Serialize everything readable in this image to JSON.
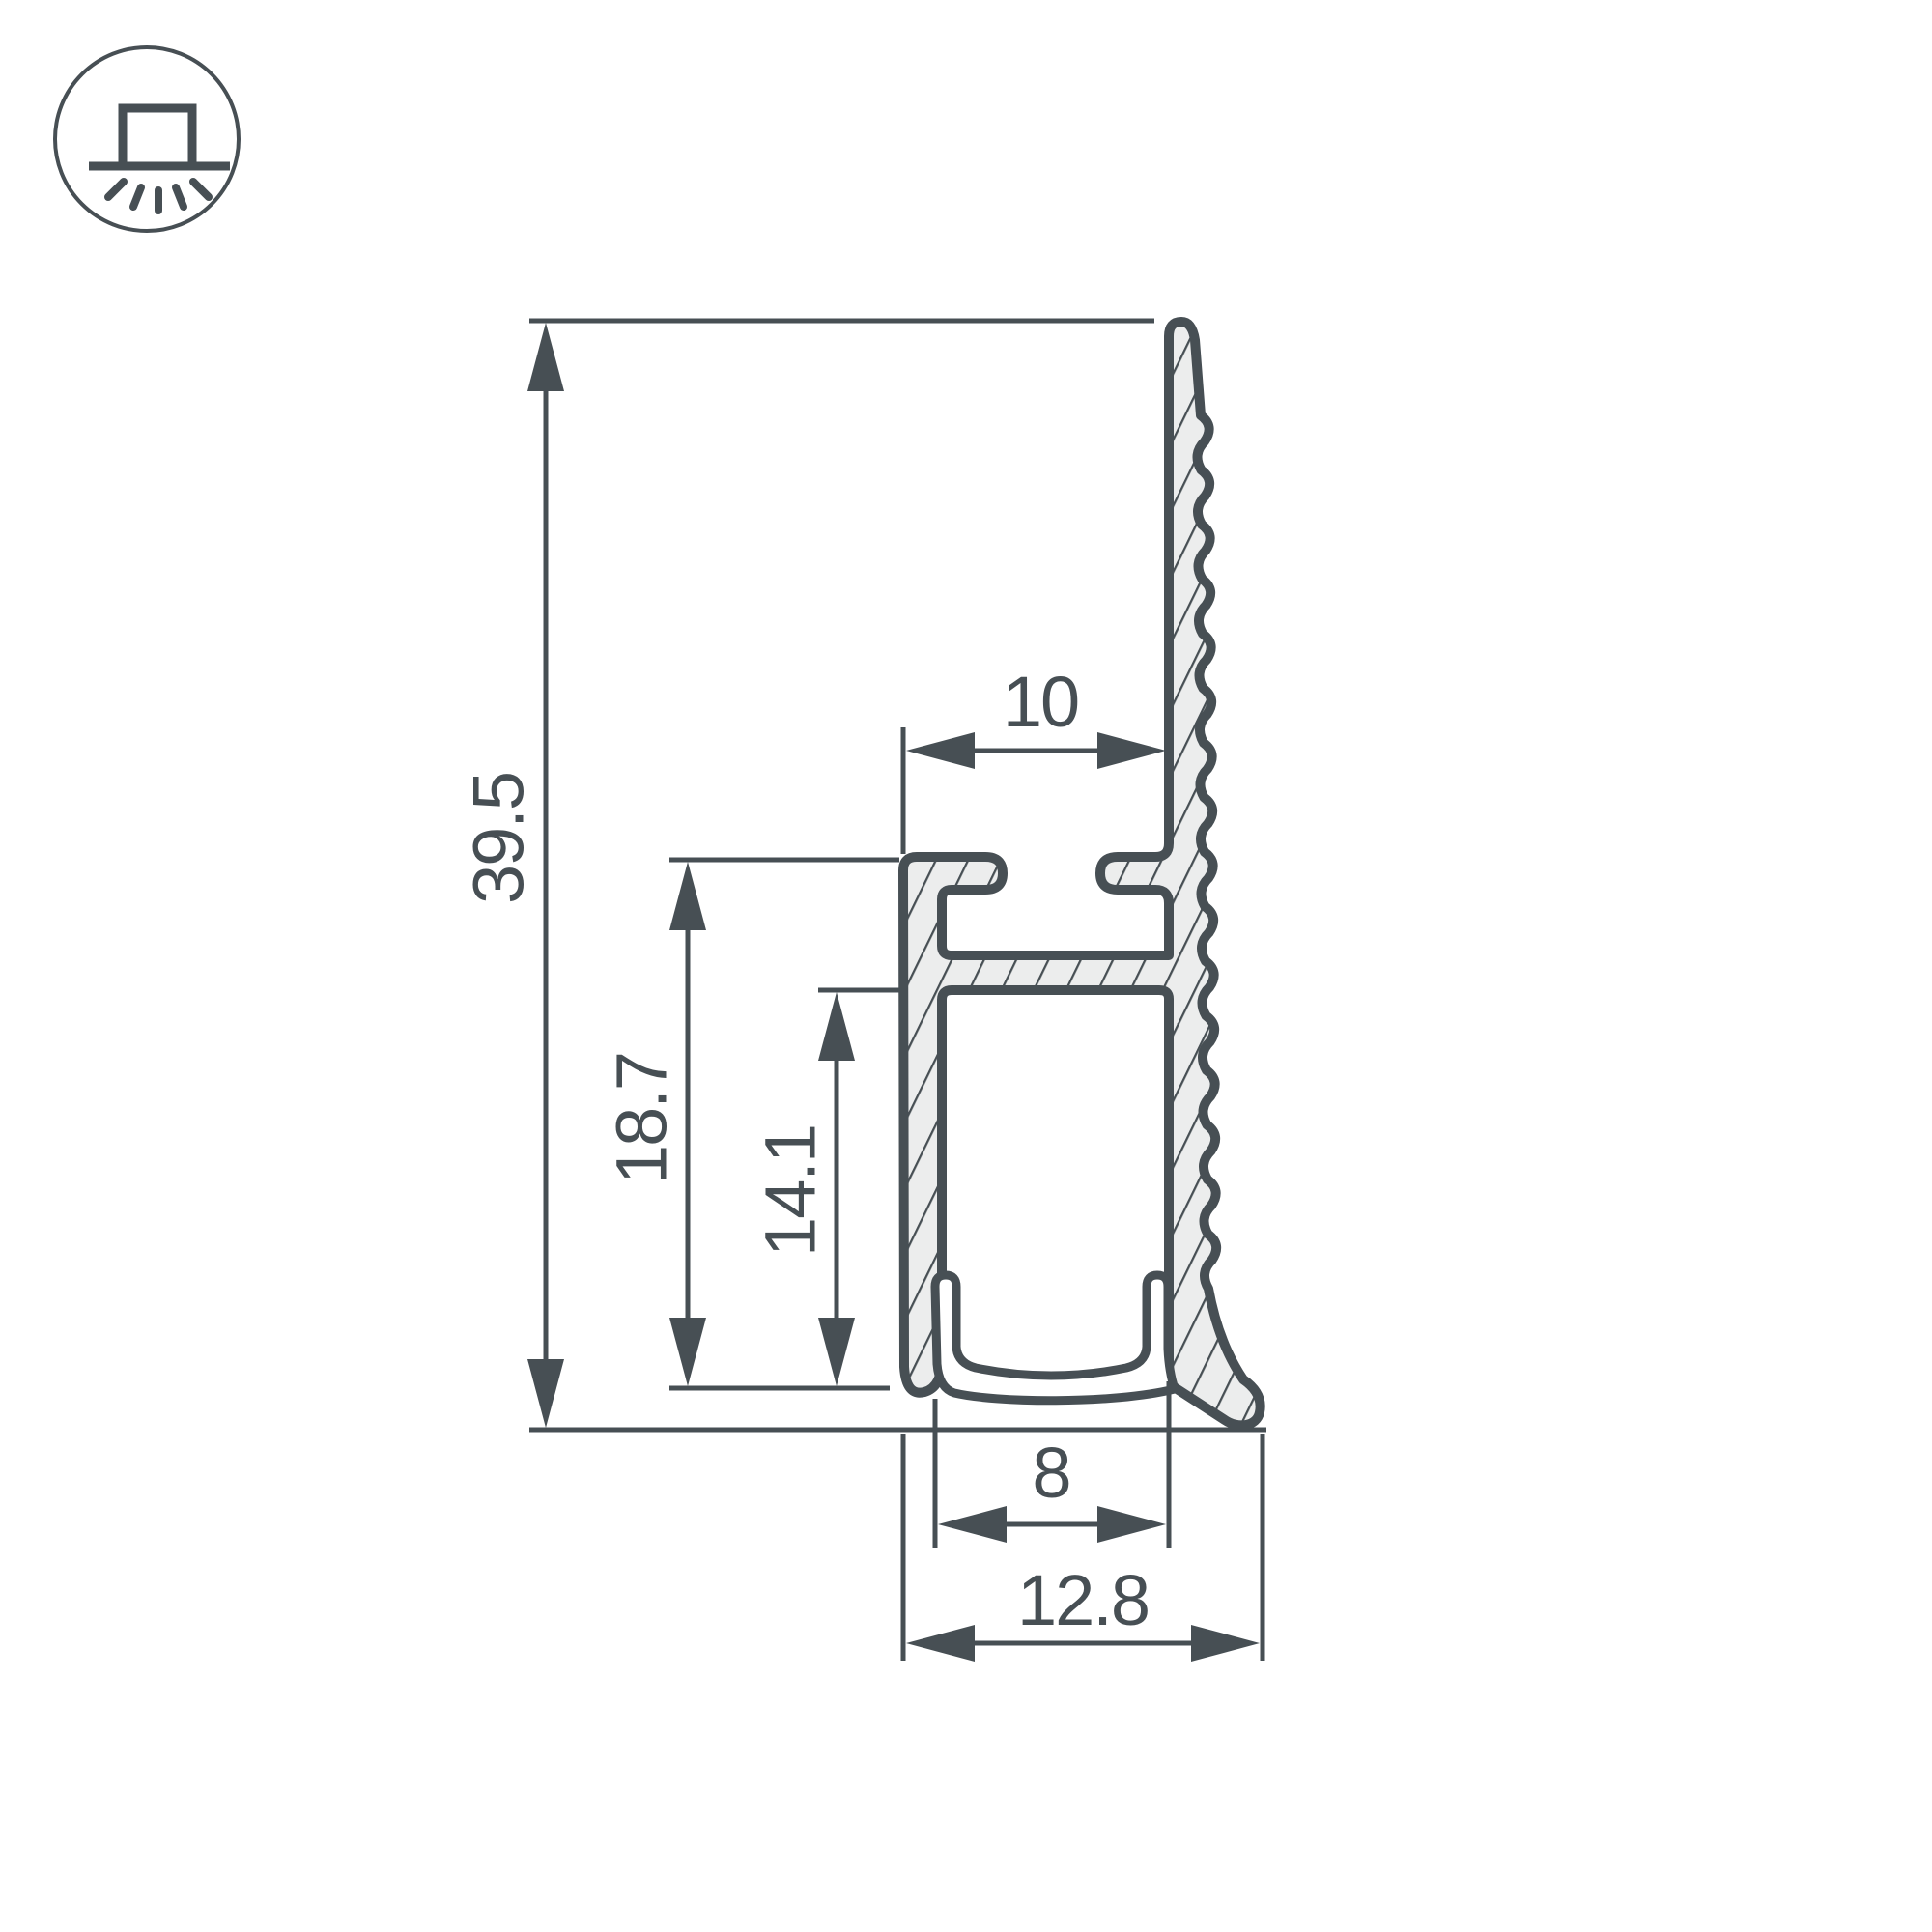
{
  "page": {
    "type": "technical-drawing",
    "background": "#ffffff"
  },
  "icon": {
    "name": "surface-mounted-light-icon"
  },
  "colors": {
    "line": "#474f54",
    "fill": "#ecedee",
    "circle": "#565d61",
    "cover": "#ffffff"
  },
  "dimensions": {
    "overall_height_mm": "39.5",
    "mount_height_mm": "18.7",
    "channel_height_mm": "14.1",
    "top_slot_width_mm": "10",
    "led_channel_width_mm": "8",
    "overall_width_mm": "12.8"
  }
}
